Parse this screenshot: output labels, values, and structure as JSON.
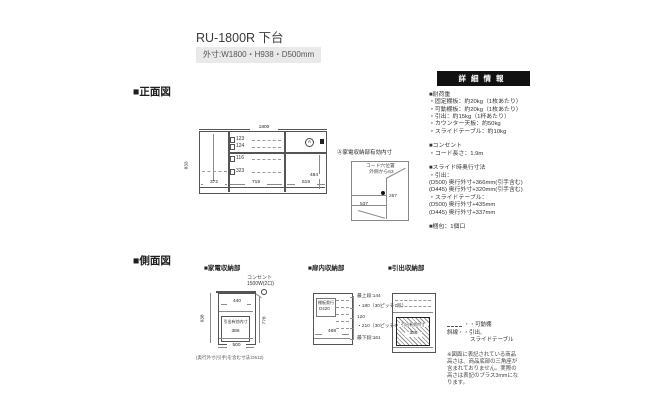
{
  "header": {
    "title": "RU-1800R 下台",
    "size_badge": "外寸:W1800・H938・D500mm"
  },
  "front_view": {
    "label": "■正面図",
    "overall_width": "1800",
    "overall_height": "833",
    "rows": [
      "123",
      "124",
      "116",
      "323"
    ],
    "bottom_widths": [
      "372",
      "719",
      "519"
    ],
    "right_height": "484",
    "marker": "A",
    "annotation": {
      "title": "Ⓐ家電収納部有効内寸",
      "cord_l1": "コード穴位置",
      "cord_l2": "外側から63",
      "inner_h": "267",
      "inner_w": "537"
    }
  },
  "detail_panel": {
    "header": "詳細情報",
    "lines": [
      "■耐荷重",
      "・固定棚板：約20kg（1枚あたり）",
      "・可動棚板：約20kg（1枚あたり）",
      "・引出：約15kg（1杯あたり）",
      "・カウンター天板：約50kg",
      "・スライドテーブル：約10kg",
      "",
      "■コンセント",
      "・コード長さ：1.9m",
      "",
      "■スライド時奥行寸法",
      "・引出：",
      "(D500) 奥行外寸+366mm(引手含む)",
      "(D445) 奥行外寸+320mm(引手含む)",
      "・スライドテーブル：",
      "(D500) 奥行外寸+435mm",
      "(D445) 奥行外寸+337mm",
      "",
      "■梱包：1個口"
    ]
  },
  "side_view": {
    "label": "■側面図",
    "appliance": {
      "title": "■家電収納部",
      "outlet_l1": "コンセント",
      "outlet_l2": "1500W(2口)",
      "height": "938",
      "inner_height": "778",
      "top_depth": "440",
      "drawer_label": "引出有効内寸",
      "drawer_depth": "386",
      "depth": "500",
      "note": "(奥行外寸(引手)を含む寸法:D512)"
    },
    "door": {
      "title": "■扉内収納部",
      "shelf_l1": "棚板奥行",
      "shelf_l2": "D420",
      "width": "468",
      "ticks": [
        "最上段:144",
        "・180（30ピッチ7段）",
        "120",
        "・210（30ピッチ6段）",
        "最下段:161"
      ]
    },
    "drawer": {
      "title": "■引出収納部",
      "drawer_label": "引出有効内寸",
      "drawer_depth": "386"
    },
    "legend": {
      "movable": "・・可動棚",
      "drawer_l1": "斜線・・引出、",
      "drawer_l2": "スライドテーブル"
    },
    "note_lines": [
      "※図面に表記されている商品",
      "高さは、商品底部の三角座が",
      "含まれておりません。実際の",
      "高さは表記のプラス3mmにな",
      "ります。"
    ]
  }
}
